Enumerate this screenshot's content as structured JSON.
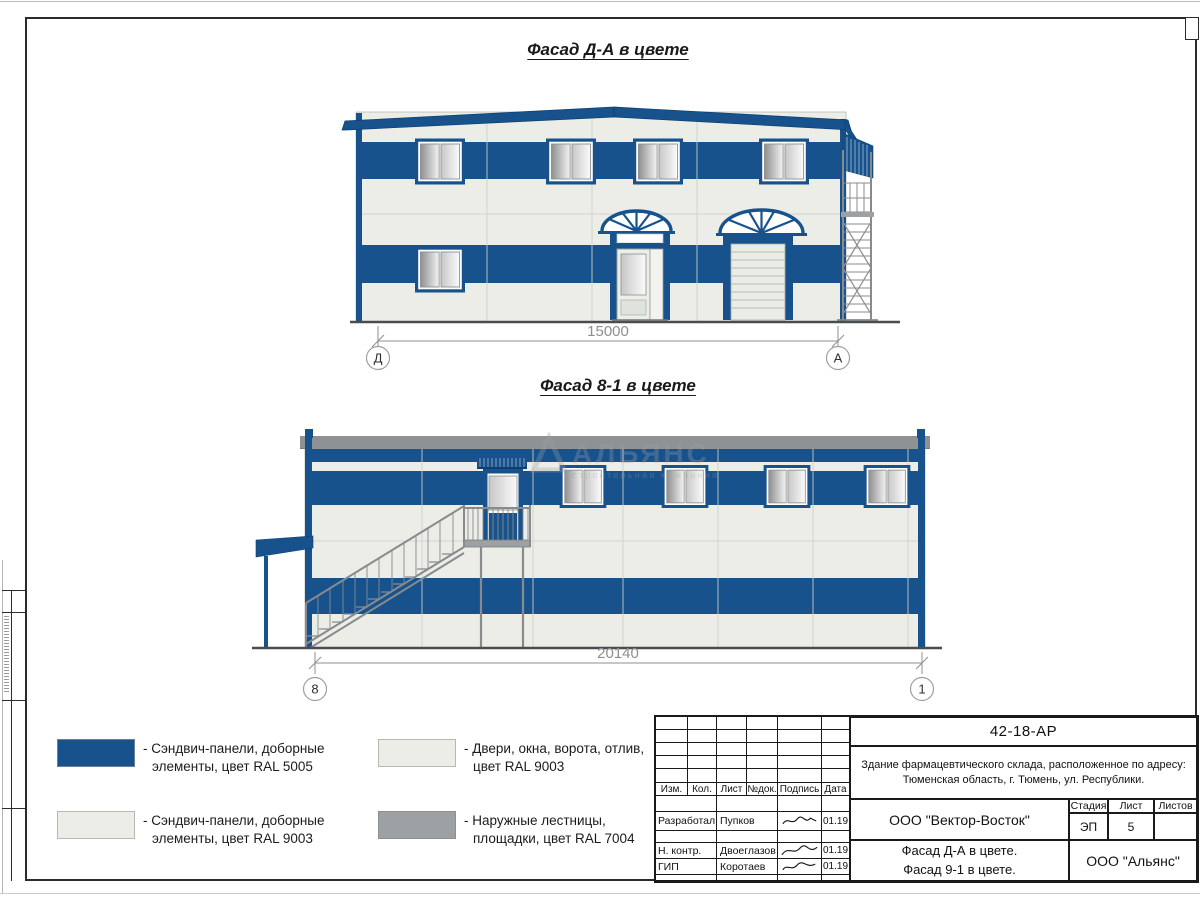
{
  "colors": {
    "blue": "#17528C",
    "blue_dark": "#0F3F70",
    "panel": "#ECEDE7",
    "gray": "#9EA1A3",
    "parapet": "#8F9294",
    "stair": "#878B8E",
    "seam": "#CDD0CA",
    "dim": "#8F8F8F"
  },
  "facade1": {
    "title": "Фасад Д-А в цвете",
    "dimension": "15000",
    "axis_left": "Д",
    "axis_right": "А"
  },
  "facade2": {
    "title": "Фасад 8-1 в цвете",
    "dimension": "20140",
    "axis_left": "8",
    "axis_right": "1"
  },
  "watermark": {
    "name": "АЛЬЯНС",
    "tagline": "строительная компания"
  },
  "legend": {
    "items": [
      {
        "line1": "- Сэндвич-панели, доборные",
        "line2": "элементы, цвет RAL 5005"
      },
      {
        "line1": "- Сэндвич-панели, доборные",
        "line2": "элементы, цвет RAL 9003"
      },
      {
        "line1": "- Двери, окна, ворота, отлив,",
        "line2": "цвет RAL 9003"
      },
      {
        "line1": "- Наружные лестницы,",
        "line2": "площадки, цвет RAL 7004"
      }
    ]
  },
  "titleblock": {
    "doc_number": "42-18-АР",
    "project_line1": "Здание фармацевтического склада, расположенное по адресу:",
    "project_line2": "Тюменская область, г. Тюмень, ул. Республики.",
    "columns": [
      "Изм.",
      "Кол.",
      "Лист",
      "№док.",
      "Подпись",
      "Дата"
    ],
    "signers": [
      {
        "role": "Разработал",
        "name": "Пупков",
        "date": "01.19"
      },
      {
        "role": "Н. контр.",
        "name": "Двоеглазов",
        "date": "01.19"
      },
      {
        "role": "ГИП",
        "name": "Коротаев",
        "date": "01.19"
      }
    ],
    "designer": "ООО \"Вектор-Восток\"",
    "stage_label": "Стадия",
    "sheet_label": "Лист",
    "sheets_label": "Листов",
    "stage": "ЭП",
    "sheet": "5",
    "sheets": "",
    "subject_line1": "Фасад Д-А в цвете.",
    "subject_line2": "Фасад 9-1 в цвете.",
    "client": "ООО \"Альянс\""
  }
}
